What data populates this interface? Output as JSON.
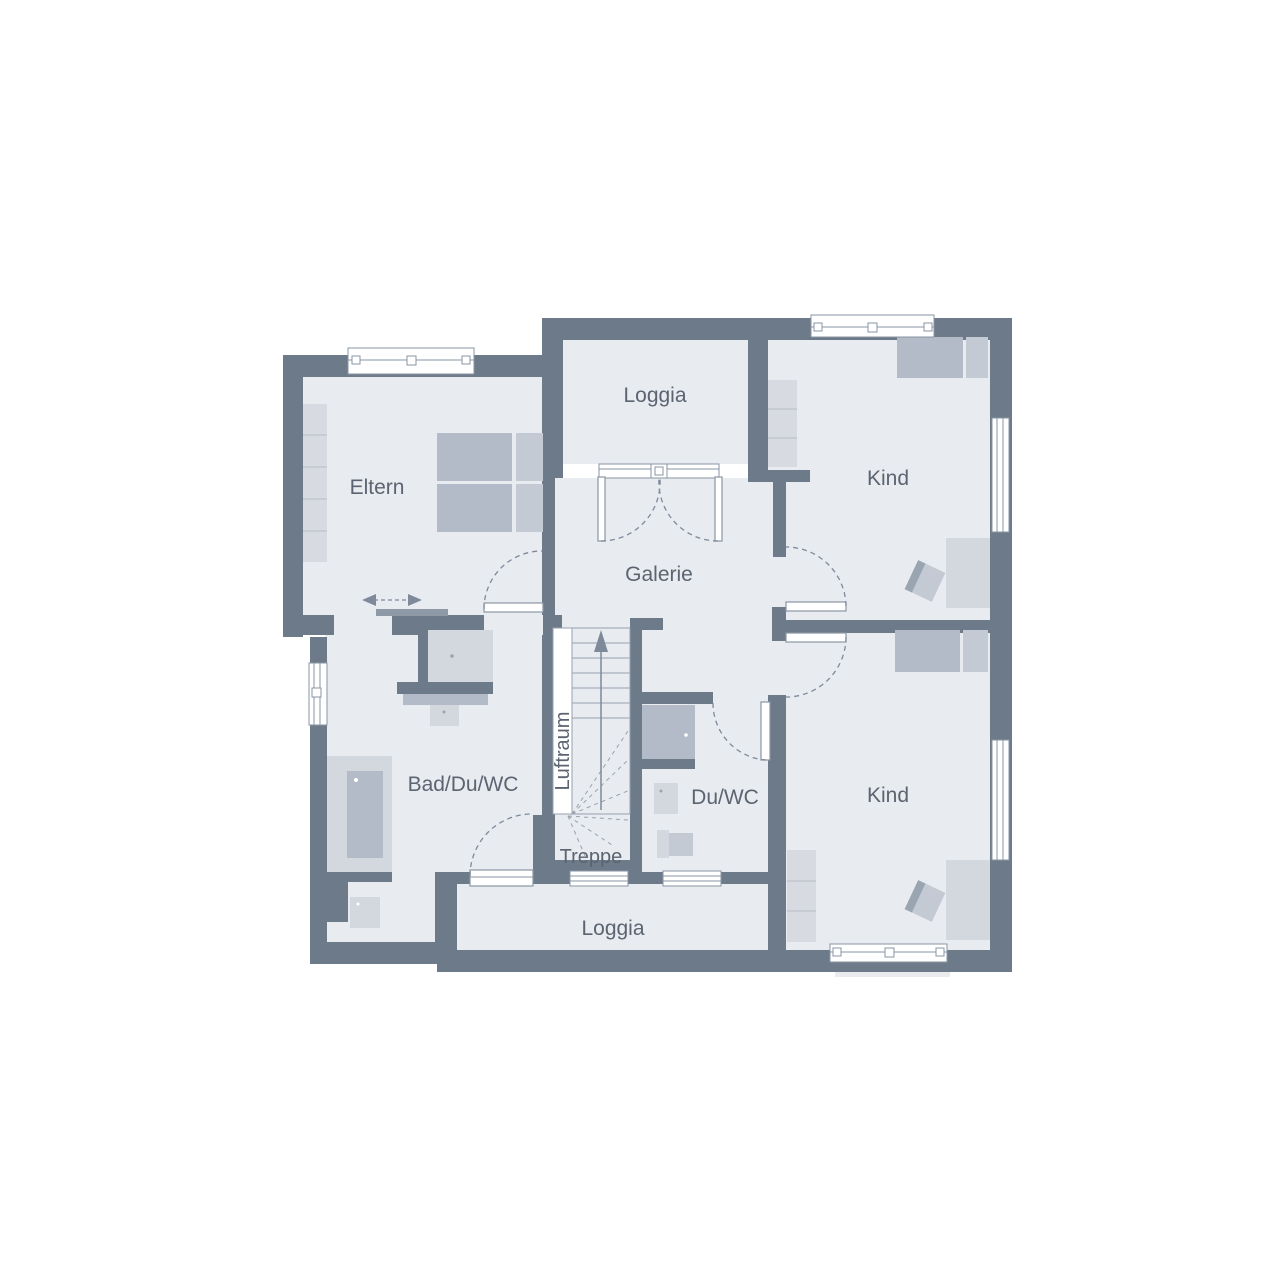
{
  "floor_plan": {
    "rooms": {
      "eltern": {
        "label": "Eltern"
      },
      "loggia_top": {
        "label": "Loggia"
      },
      "kind_top": {
        "label": "Kind"
      },
      "galerie": {
        "label": "Galerie"
      },
      "bad_du_wc": {
        "label": "Bad/Du/WC"
      },
      "luftraum": {
        "label": "Luftraum"
      },
      "treppe": {
        "label": "Treppe"
      },
      "du_wc": {
        "label": "Du/WC"
      },
      "kind_bottom": {
        "label": "Kind"
      },
      "loggia_bottom": {
        "label": "Loggia"
      }
    },
    "colors": {
      "wall": "#6d7a8a",
      "floor": "#e8ebf0",
      "bg": "#ffffff",
      "furn_dark": "#b2bbc7",
      "furn_light": "#d3d7de",
      "furn_mid": "#c3cad4",
      "wardrobe": "#d7dbe1",
      "wardrobe_line": "#c2c8d0",
      "sym": "#8a95a3",
      "dash": "#7e8a99",
      "text": "#5b6470",
      "panel": "#8d99a7"
    }
  }
}
